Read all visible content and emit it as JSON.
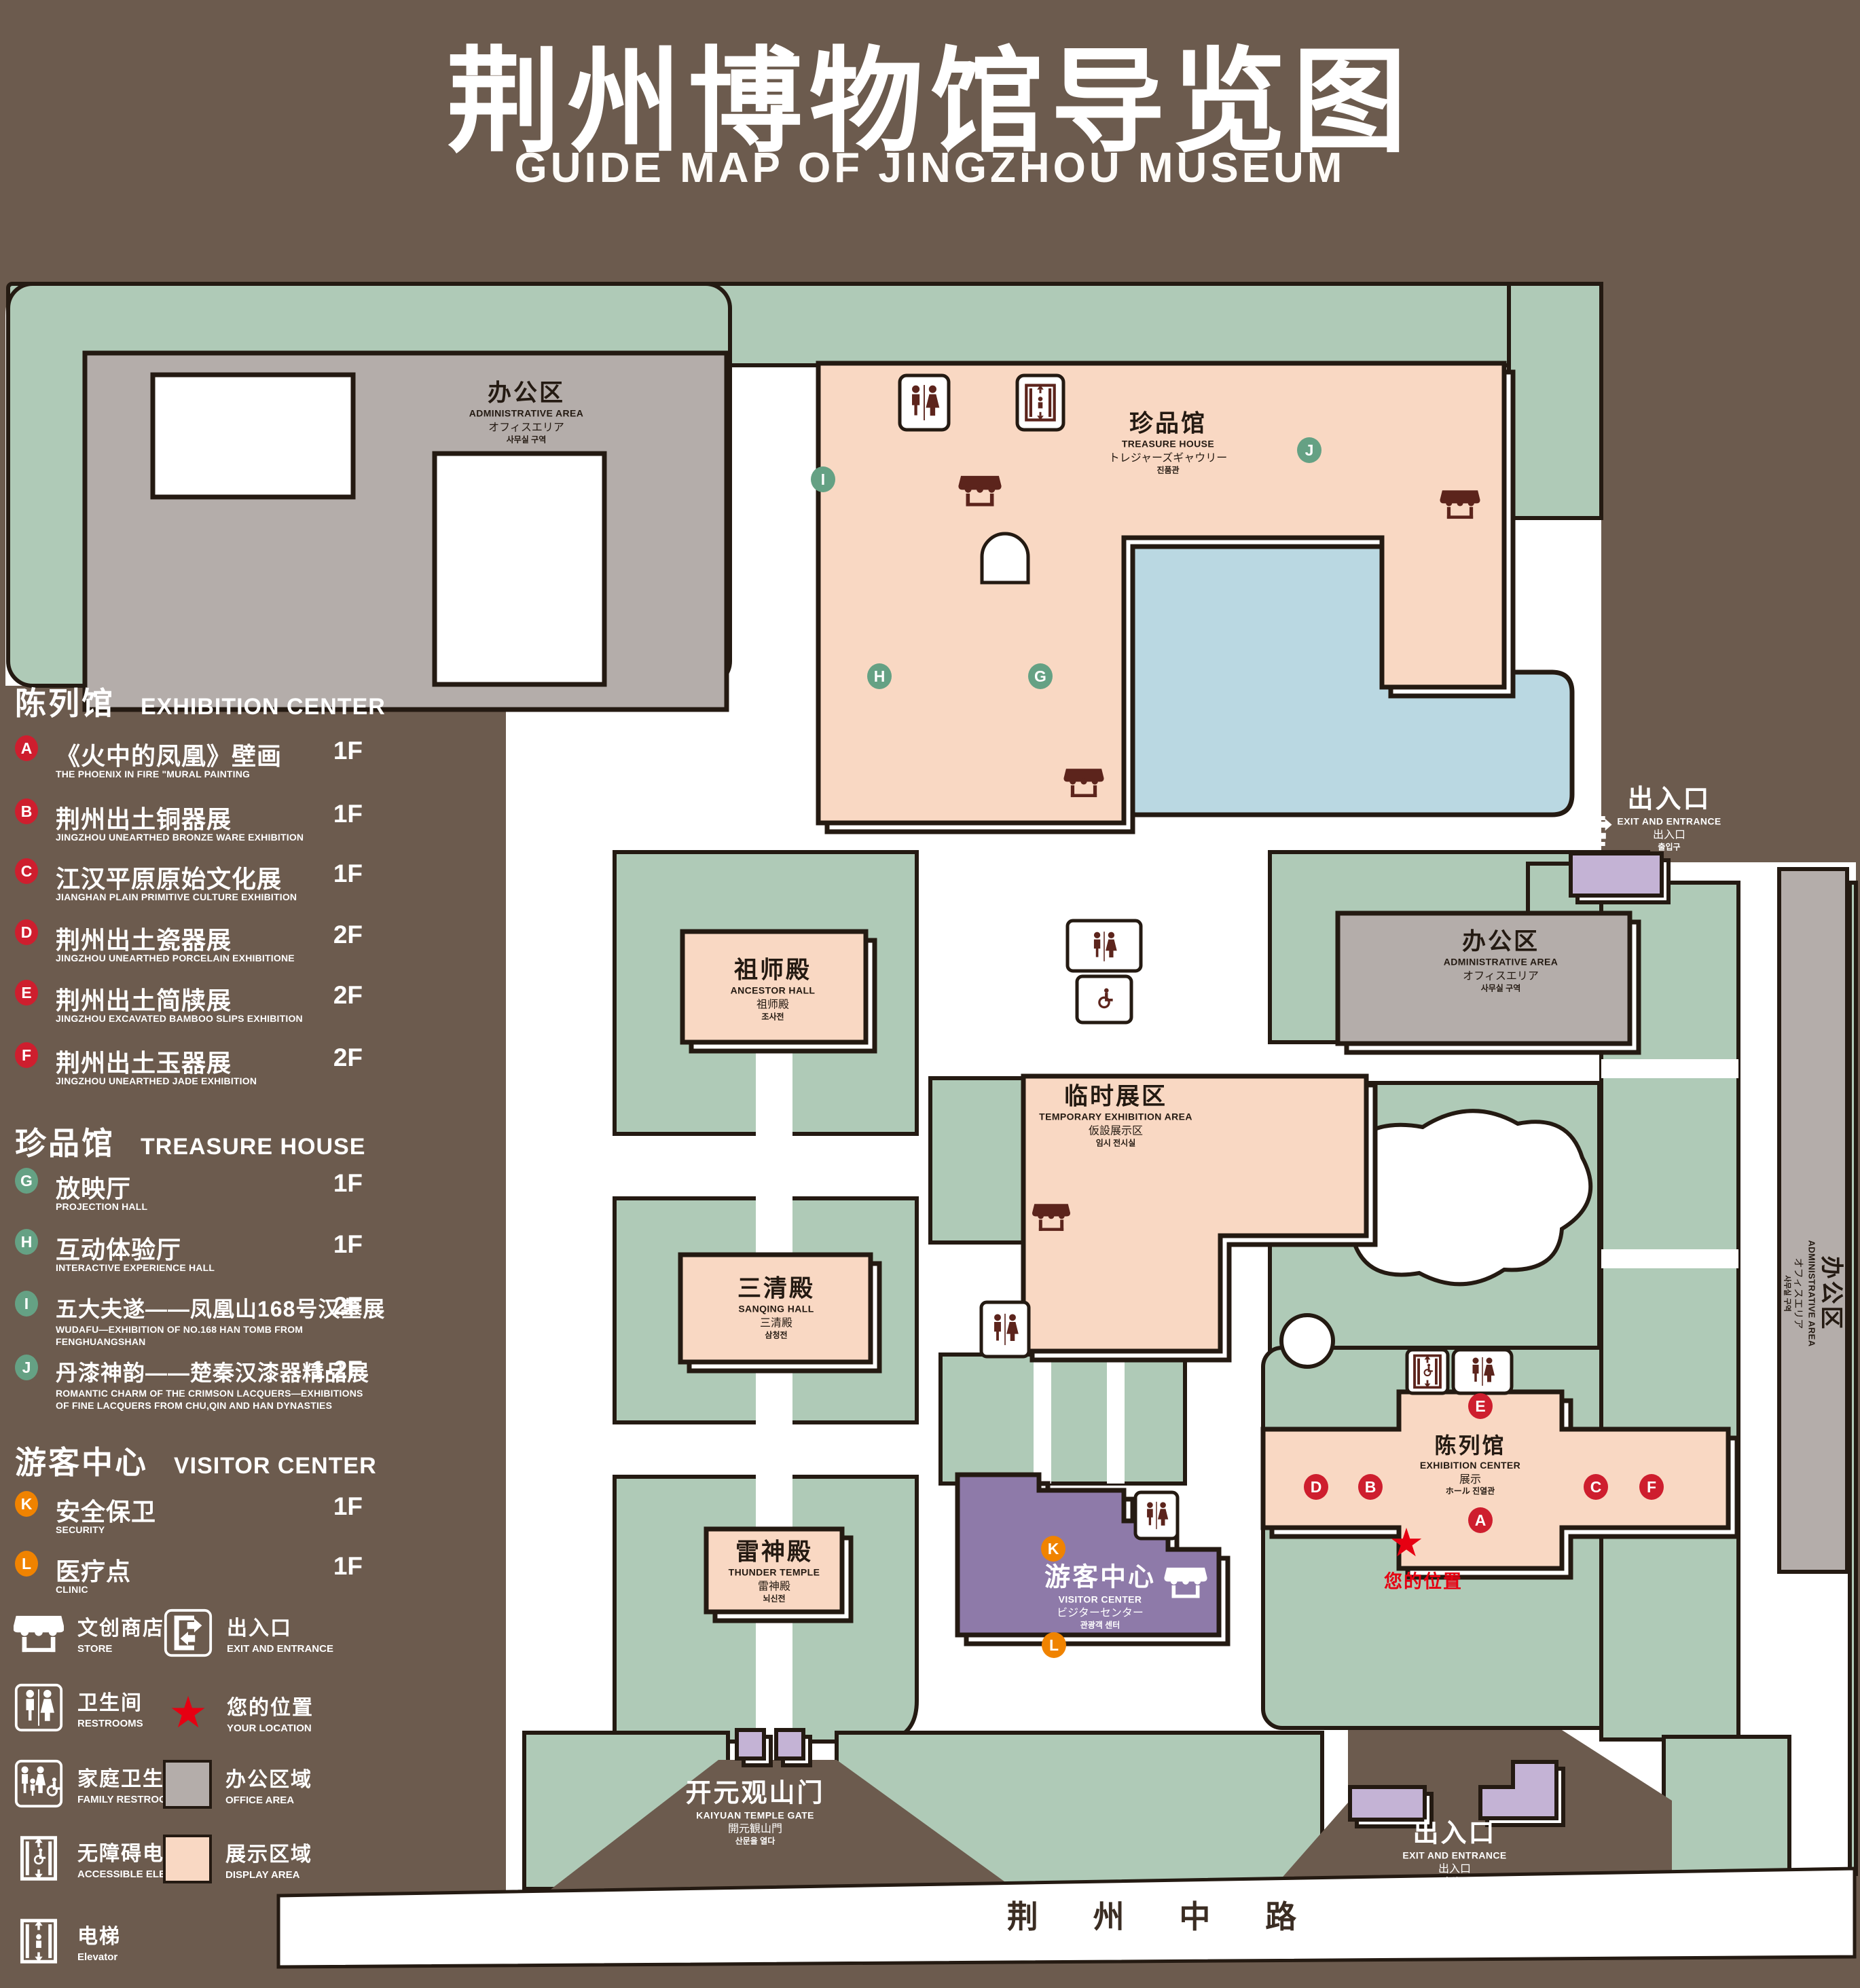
{
  "title": {
    "zh": "荆州博物馆导览图",
    "en": "GUIDE MAP OF JINGZHOU MUSEUM"
  },
  "palette": {
    "background_brown": "#6c5b4e",
    "campus_green": "#afcab7",
    "display_pink": "#f9d8c3",
    "office_gray": "#b4adaa",
    "visitor_purple": "#8e7aa9",
    "lavender": "#c4b3d5",
    "pond_blue": "#bad8e2",
    "outline_dark": "#241a12",
    "marker_red": "#ce1e2e",
    "marker_green": "#65a184",
    "marker_orange": "#f08300",
    "location_red": "#e60012",
    "icon_maroon": "#5c241c"
  },
  "legend": {
    "sections": [
      {
        "zh": "陈列馆",
        "en": "EXHIBITION CENTER",
        "items": [
          {
            "letter": "A",
            "zh": "《火中的凤凰》壁画",
            "en": "THE PHOENIX IN FIRE \"MURAL PAINTING",
            "floor": "1F"
          },
          {
            "letter": "B",
            "zh": "荆州出土铜器展",
            "en": "JINGZHOU UNEARTHED BRONZE WARE EXHIBITION",
            "floor": "1F"
          },
          {
            "letter": "C",
            "zh": "江汉平原原始文化展",
            "en": "JIANGHAN PLAIN PRIMITIVE CULTURE EXHIBITION",
            "floor": "1F"
          },
          {
            "letter": "D",
            "zh": "荆州出土瓷器展",
            "en": "JINGZHOU UNEARTHED PORCELAIN EXHIBITIONE",
            "floor": "2F"
          },
          {
            "letter": "E",
            "zh": "荆州出土简牍展",
            "en": "JINGZHOU EXCAVATED BAMBOO SLIPS EXHIBITION",
            "floor": "2F"
          },
          {
            "letter": "F",
            "zh": "荆州出土玉器展",
            "en": "JINGZHOU UNEARTHED JADE EXHIBITION",
            "floor": "2F"
          }
        ]
      },
      {
        "zh": "珍品馆",
        "en": "TREASURE HOUSE",
        "items": [
          {
            "letter": "G",
            "zh": "放映厅",
            "en": "PROJECTION HALL",
            "floor": "1F"
          },
          {
            "letter": "H",
            "zh": "互动体验厅",
            "en": "INTERACTIVE EXPERIENCE HALL",
            "floor": "1F"
          },
          {
            "letter": "I",
            "zh": "五大夫遂——凤凰山168号汉墓展",
            "en": "WUDAFU—EXHIBITION OF NO.168 HAN TOMB FROM FENGHUANGSHAN",
            "floor": "2F"
          },
          {
            "letter": "J",
            "zh": "丹漆神韵——楚秦汉漆器精品展",
            "en": "ROMANTIC CHARM OF THE CRIMSON LACQUERS—EXHIBITIONS OF FINE LACQUERS FROM CHU,QIN AND HAN DYNASTIES",
            "floor": "1-2F"
          }
        ]
      },
      {
        "zh": "游客中心",
        "en": "VISITOR CENTER",
        "items": [
          {
            "letter": "K",
            "zh": "安全保卫",
            "en": "SECURITY",
            "floor": "1F"
          },
          {
            "letter": "L",
            "zh": "医疗点",
            "en": "CLINIC",
            "floor": "1F"
          }
        ]
      }
    ],
    "symbols_left": [
      {
        "zh": "文创商店",
        "en": "STORE"
      },
      {
        "zh": "卫生间",
        "en": "RESTROOMS"
      },
      {
        "zh": "家庭卫生间",
        "en": "FAMILY RESTROOMS"
      },
      {
        "zh": "无障碍电梯",
        "en": "ACCESSIBLE ELEVATOR"
      },
      {
        "zh": "电梯",
        "en": "Elevator"
      }
    ],
    "symbols_right": [
      {
        "zh": "出入口",
        "en": "EXIT AND ENTRANCE"
      },
      {
        "zh": "您的位置",
        "en": "YOUR LOCATION"
      },
      {
        "zh": "办公区域",
        "en": "OFFICE AREA"
      },
      {
        "zh": "展示区域",
        "en": "DISPLAY AREA"
      }
    ]
  },
  "map": {
    "admin": {
      "zh": "办公区",
      "en": "ADMINISTRATIVE AREA",
      "l3": "オフィスエリア",
      "l4": "사무실 구역"
    },
    "treasure_house": {
      "zh": "珍品馆",
      "en": "TREASURE HOUSE",
      "l3": "トレジャーズギャウリー",
      "l4": "진품관"
    },
    "ancestor_hall": {
      "zh": "祖师殿",
      "en": "ANCESTOR HALL",
      "l3": "祖师殿",
      "l4": "조사전"
    },
    "temporary_area": {
      "zh": "临时展区",
      "en": "TEMPORARY EXHIBITION AREA",
      "l3": "仮設展示区",
      "l4": "임시 전시실"
    },
    "sanqing_hall": {
      "zh": "三清殿",
      "en": "SANQING HALL",
      "l3": "三清殿",
      "l4": "삼청전"
    },
    "thunder_temple": {
      "zh": "雷神殿",
      "en": "THUNDER TEMPLE",
      "l3": "雷神殿",
      "l4": "뇌신전"
    },
    "exhibition_center": {
      "zh": "陈列馆",
      "en": "EXHIBITION CENTER",
      "l3": "展示",
      "l4": "ホール 진열관"
    },
    "visitor_center": {
      "zh": "游客中心",
      "en": "VISITOR CENTER",
      "l3": "ビジターセンター",
      "l4": "관광객 센터"
    },
    "gate": {
      "zh": "开元观山门",
      "en": "KAIYUAN TEMPLE GATE",
      "l3": "開元観山門",
      "l4": "산문을 열다"
    },
    "exit": {
      "zh": "出入口",
      "en": "EXIT AND ENTRANCE",
      "l3": "出入口",
      "l4": "출입구"
    },
    "road": "荆 州 中 路",
    "your_location": "您的位置",
    "star": "★",
    "markers": {
      "a": "A",
      "b": "B",
      "c": "C",
      "d": "D",
      "e": "E",
      "f": "F",
      "g": "G",
      "h": "H",
      "i": "I",
      "j": "J",
      "k": "K",
      "l": "L"
    }
  }
}
